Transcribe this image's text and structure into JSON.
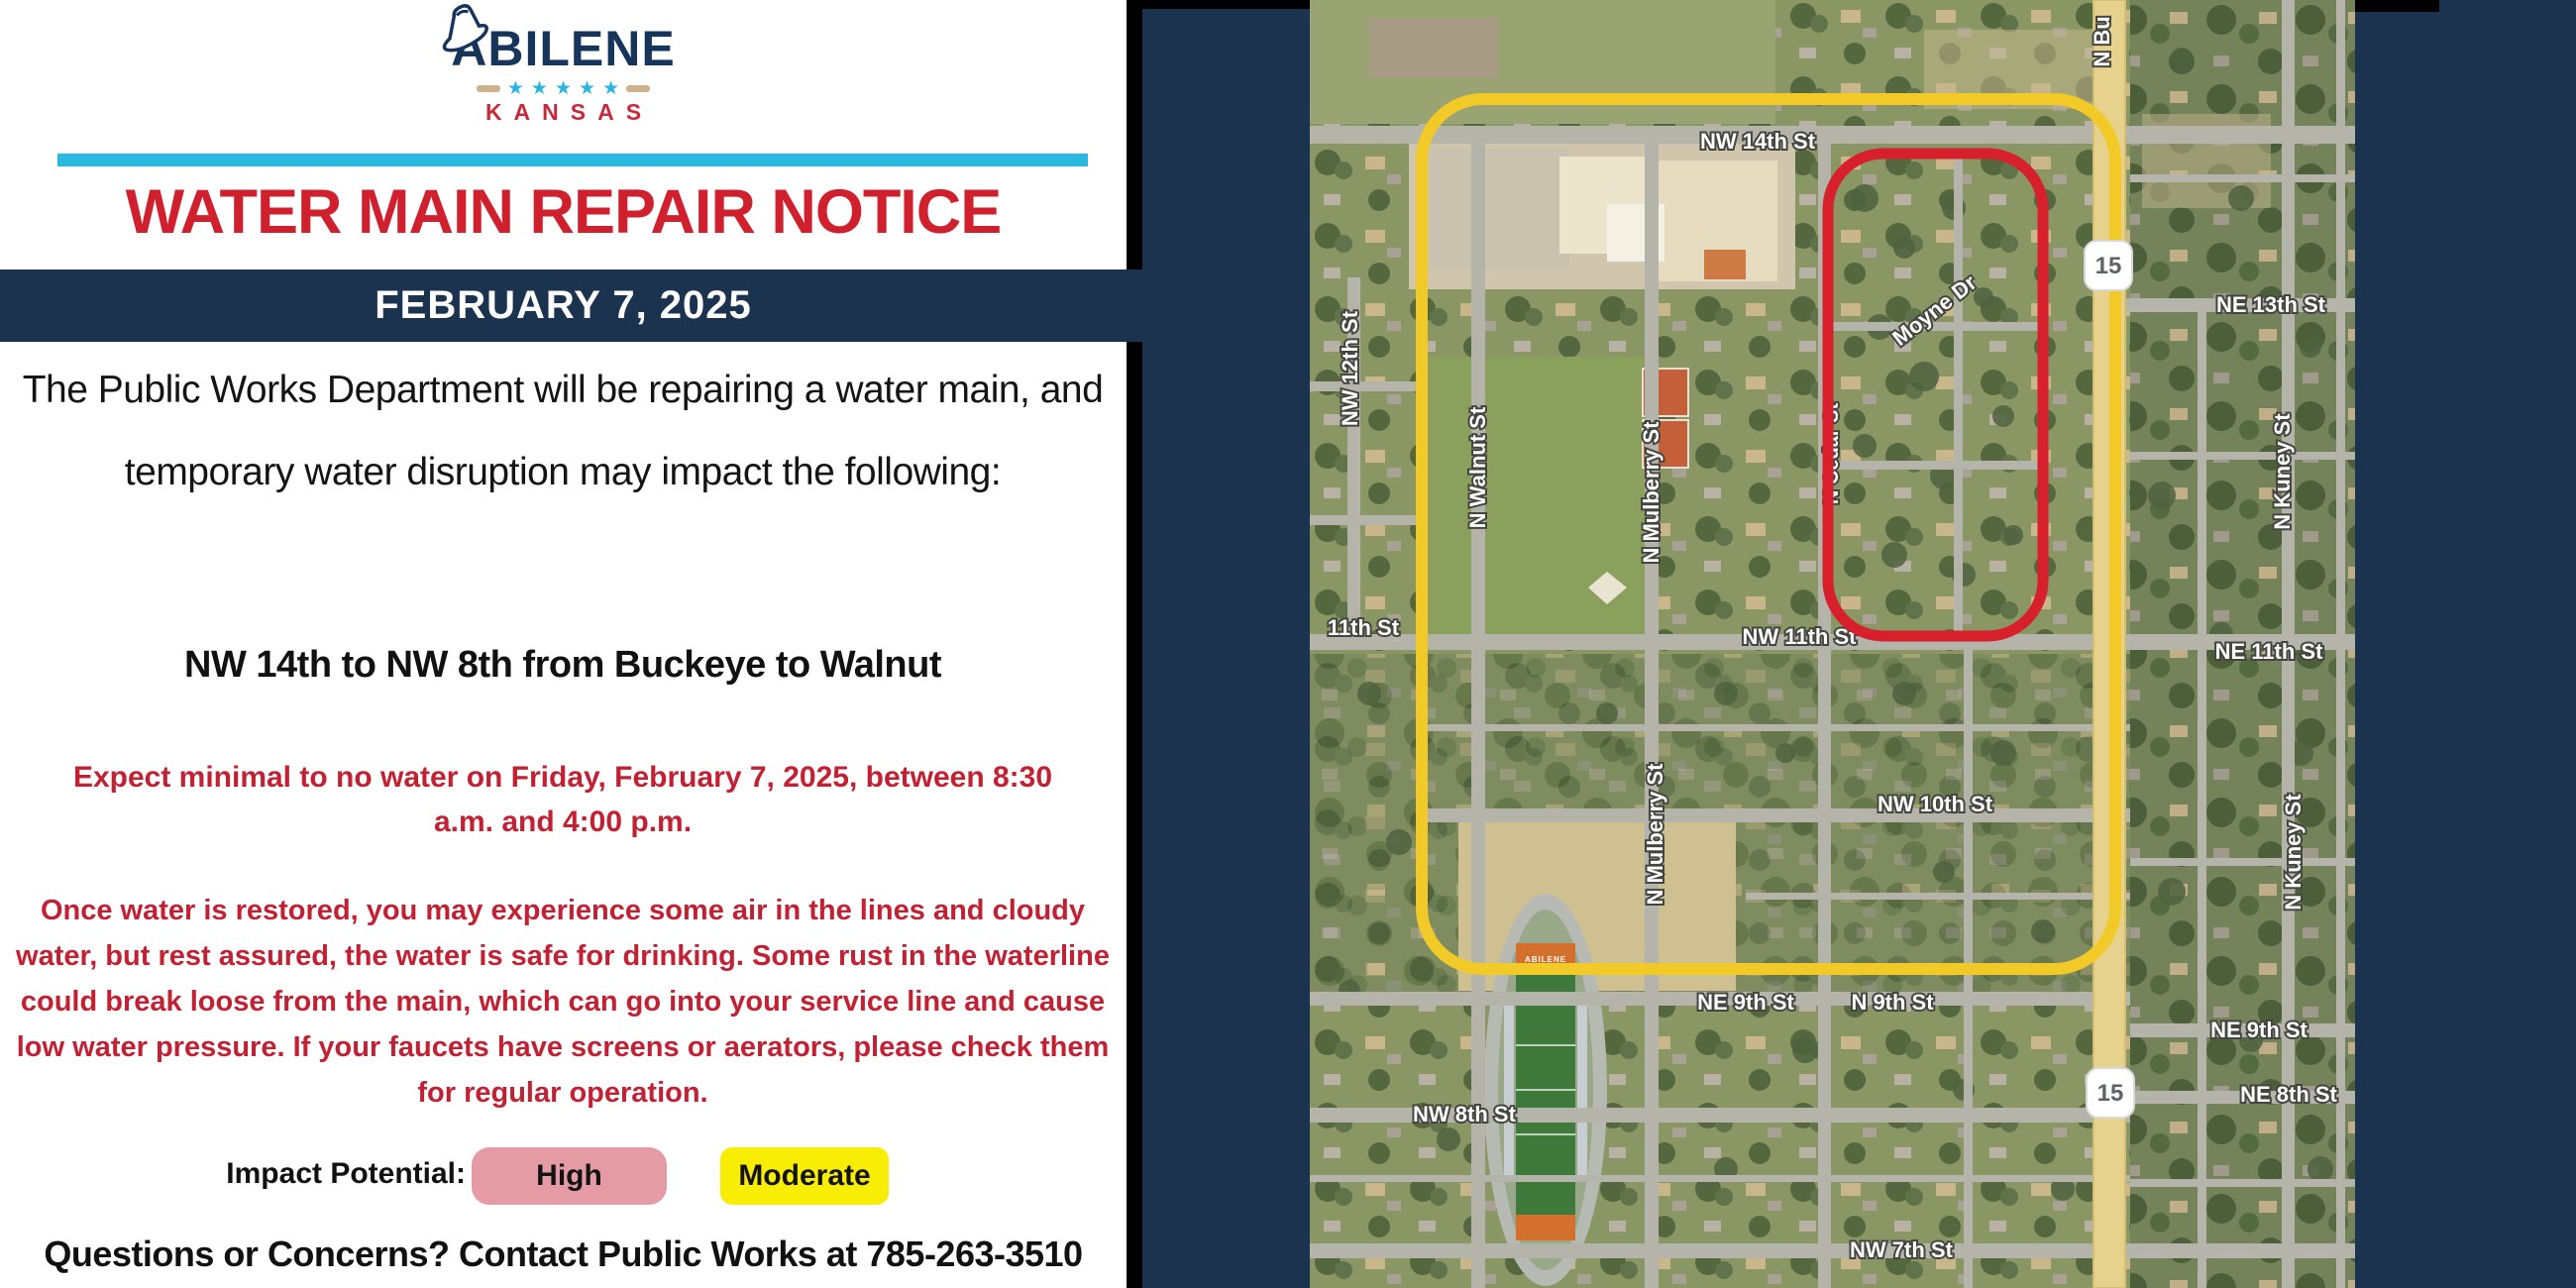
{
  "flyer": {
    "logo": {
      "name": "ABILENE",
      "state": "KANSAS"
    },
    "title": "WATER MAIN REPAIR NOTICE",
    "date_banner": "FEBRUARY 7, 2025",
    "intro": "The Public Works Department will be repairing a water main, and temporary water disruption may impact the following:",
    "affected_area": "NW 14th to NW 8th from Buckeye to Walnut",
    "outage_notice": "Expect minimal to no water on Friday, February 7, 2025, between 8:30 a.m. and 4:00 p.m.",
    "restoration_notice": "Once water is restored, you may experience some air in the lines and cloudy water, but rest assured, the water is safe for drinking. Some rust in the waterline could break loose from the main, which can go into your service line and cause low water pressure. If your faucets have screens or aerators, please check them for regular operation.",
    "impact": {
      "label": "Impact Potential:",
      "levels": [
        {
          "label": "High",
          "color": "#e49ba5"
        },
        {
          "label": "Moderate",
          "color": "#f8ee05"
        }
      ]
    },
    "contact": "Questions or Concerns? Contact Public Works at 785-263-3510",
    "colors": {
      "navy": "#1c3350",
      "title_red": "#d0202e",
      "body_red": "#c22133",
      "cyan_bar": "#29b9e0"
    }
  },
  "map": {
    "zones": [
      {
        "name": "high-impact-zone",
        "outline_color": "#d7202b"
      },
      {
        "name": "moderate-impact-zone",
        "outline_color": "#f2ca28"
      }
    ],
    "shields": [
      {
        "label": "15"
      },
      {
        "label": "15"
      }
    ],
    "stadium_sign": "ABILENE",
    "labels": [
      {
        "text": "NW 14th St"
      },
      {
        "text": "NW 12th St"
      },
      {
        "text": "N Walnut St"
      },
      {
        "text": "N Mulberry St"
      },
      {
        "text": "N Cedar St"
      },
      {
        "text": "Moyne Dr"
      },
      {
        "text": "N Bu"
      },
      {
        "text": "NE 13th St"
      },
      {
        "text": "11th St"
      },
      {
        "text": "NW 11th St"
      },
      {
        "text": "NE 11th St"
      },
      {
        "text": "N Kuney St"
      },
      {
        "text": "NW 10th St"
      },
      {
        "text": "N Mulberry St"
      },
      {
        "text": "N Kuney St"
      },
      {
        "text": "NE 9th St"
      },
      {
        "text": "N 9th St"
      },
      {
        "text": "NE 9th St"
      },
      {
        "text": "NW 8th St"
      },
      {
        "text": "NE 8th St"
      },
      {
        "text": "NW 7th St"
      }
    ]
  }
}
